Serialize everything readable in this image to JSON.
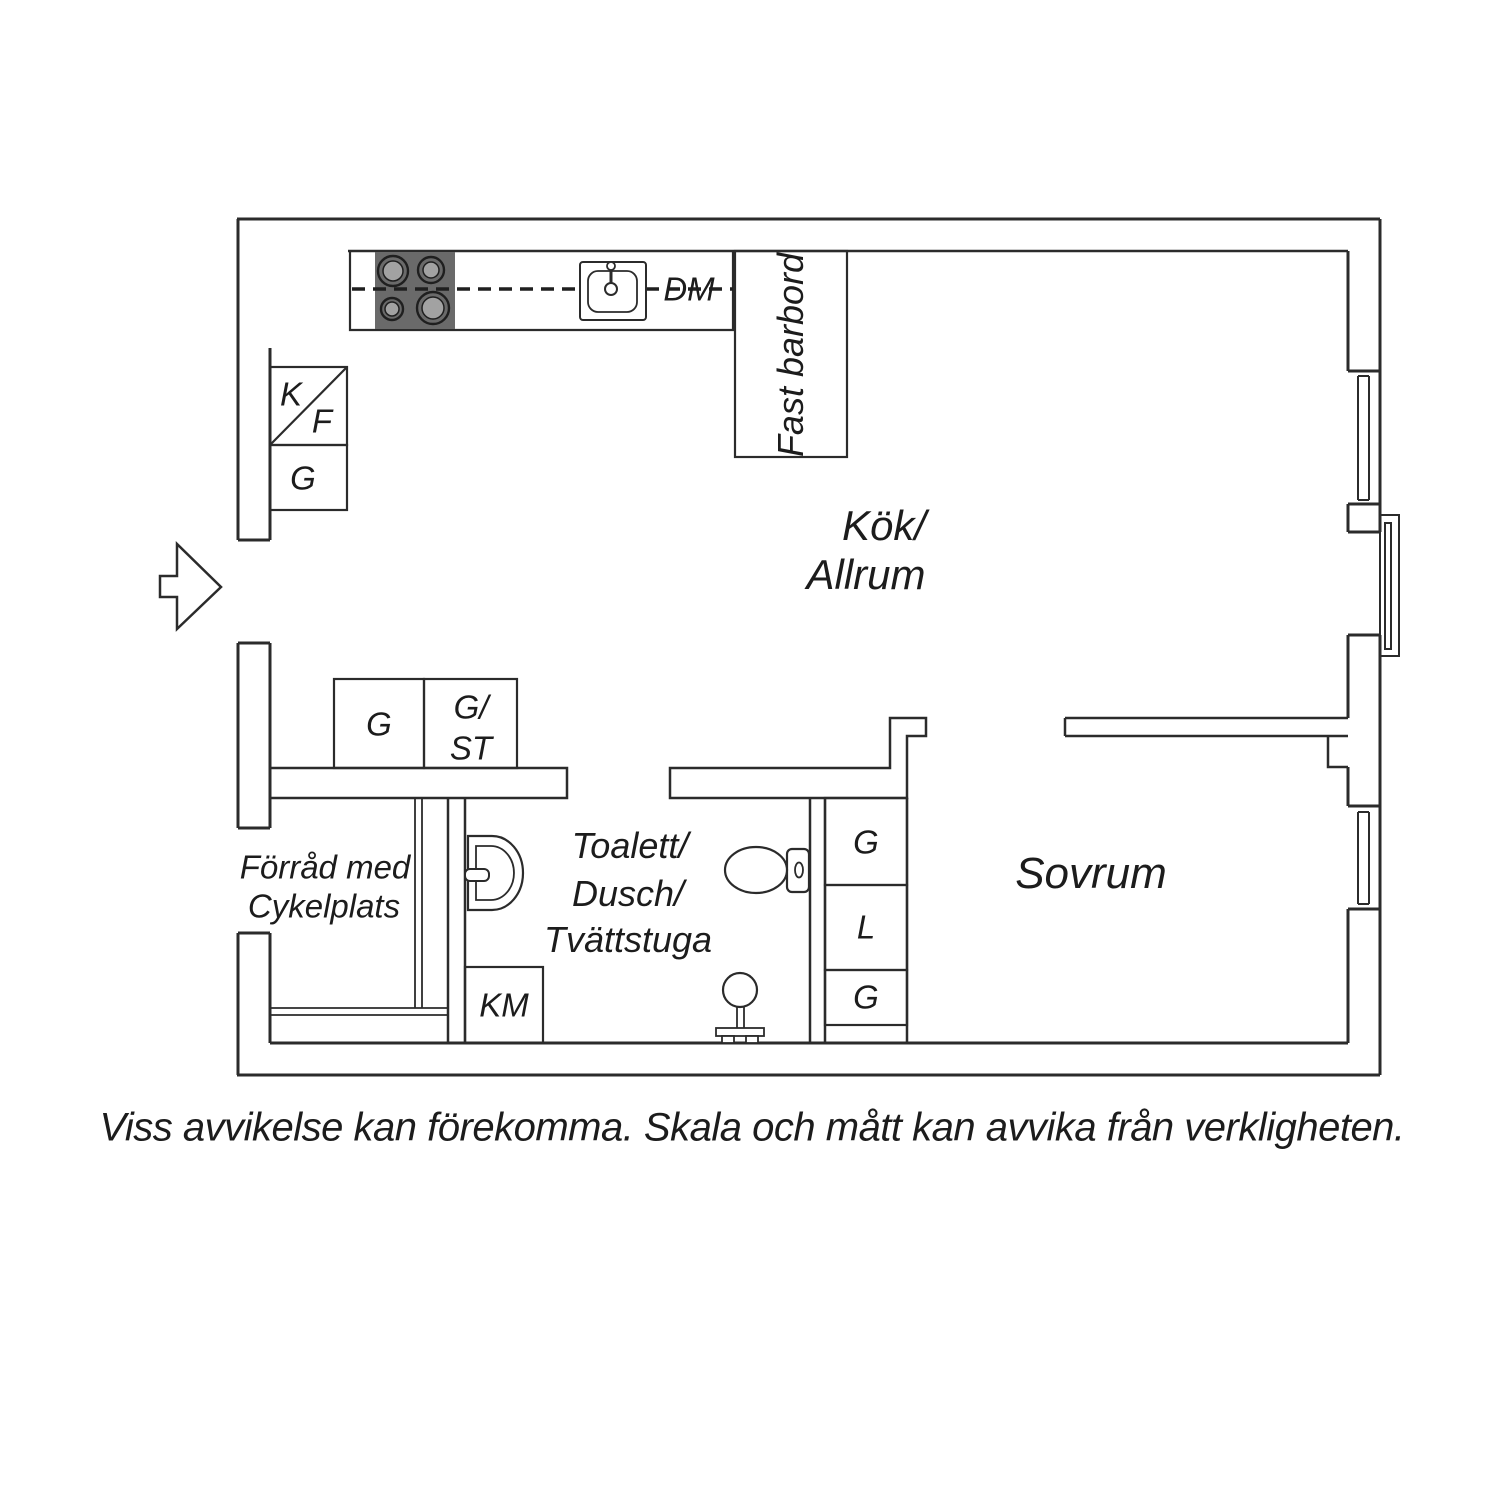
{
  "colors": {
    "line": "#2b2b2b",
    "text": "#1c1c1c",
    "stove_fill": "#6a6a6a",
    "burner_fill": "#a2a2a2",
    "background": "#ffffff"
  },
  "rooms": {
    "kitchen_living": {
      "line1": "Kök/",
      "line2": "Allrum"
    },
    "bedroom": {
      "name": "Sovrum"
    },
    "bathroom": {
      "line1": "Toalett/",
      "line2": "Dusch/",
      "line3": "Tvättstuga"
    },
    "storage": {
      "line1": "Förråd med",
      "line2": "Cykelplats"
    }
  },
  "fixtures": {
    "dishwasher": "DM",
    "bar_table": "Fast barbord",
    "fridge": "K",
    "freezer": "F",
    "wardrobe_kitchen": "G",
    "wardrobe_hall": "G",
    "wardrobe_cleaning_line1": "G/",
    "wardrobe_cleaning_line2": "ST",
    "wardrobe_bedroom_top": "G",
    "linen_closet": "L",
    "wardrobe_bedroom_bottom": "G",
    "washing_machine": "KM"
  },
  "caption": "Viss avvikelse kan förekomma. Skala och mått kan avvika från verkligheten."
}
